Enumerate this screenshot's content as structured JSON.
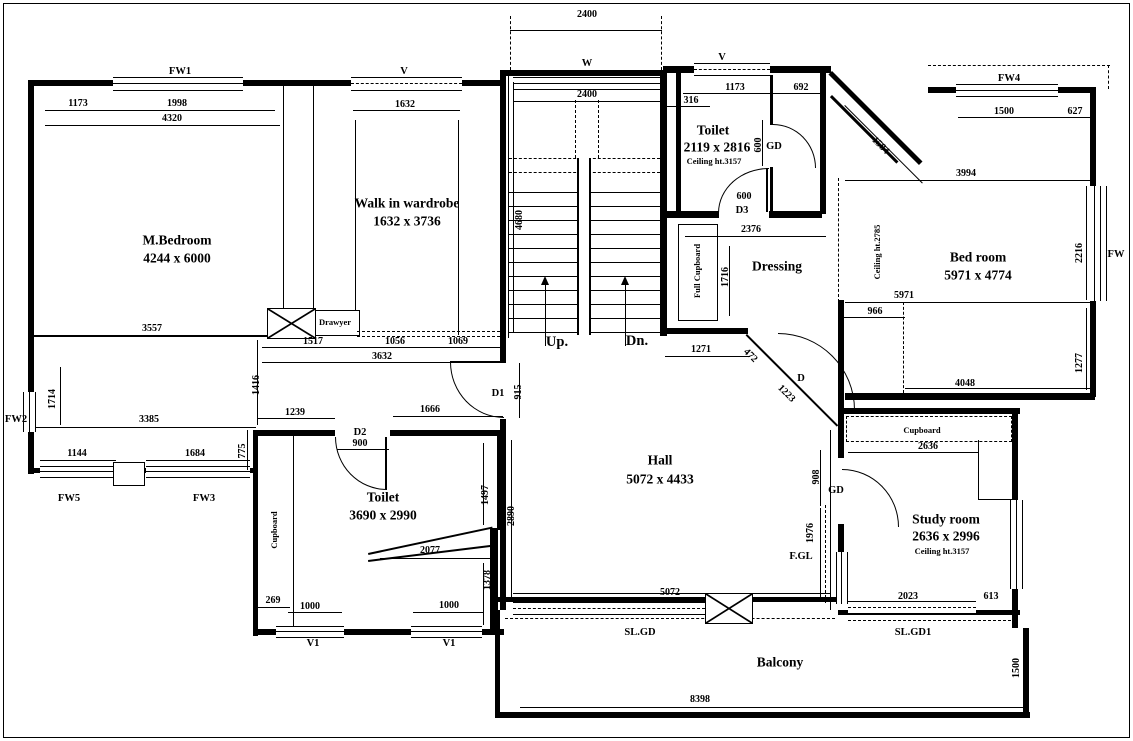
{
  "drawing_type": "residential floor plan",
  "labels": {
    "m_bedroom": [
      {
        "id": "fw1",
        "t": "FW1",
        "x": 180,
        "y": 72,
        "s": "tag"
      },
      {
        "id": "dim-1173",
        "t": "1173",
        "x": 78,
        "y": 104,
        "s": "dim"
      },
      {
        "id": "dim-1998",
        "t": "1998",
        "x": 177,
        "y": 104,
        "s": "dim"
      },
      {
        "id": "dim-4320",
        "t": "4320",
        "x": 172,
        "y": 119,
        "s": "dim"
      },
      {
        "id": "name",
        "t": "M.Bedroom",
        "x": 177,
        "y": 240,
        "s": "room"
      },
      {
        "id": "size",
        "t": "4244 x 6000",
        "x": 177,
        "y": 258,
        "s": "room"
      },
      {
        "id": "dim-3557",
        "t": "3557",
        "x": 152,
        "y": 329,
        "s": "dim"
      },
      {
        "id": "fw2",
        "t": "FW2",
        "x": 16,
        "y": 420,
        "s": "tag"
      },
      {
        "id": "dim-1714",
        "t": "1714",
        "x": 53,
        "y": 399,
        "s": "dim",
        "r": -90
      },
      {
        "id": "dim-3385",
        "t": "3385",
        "x": 149,
        "y": 420,
        "s": "dim"
      },
      {
        "id": "dim-1144",
        "t": "1144",
        "x": 77,
        "y": 454,
        "s": "dim"
      },
      {
        "id": "dim-1684",
        "t": "1684",
        "x": 195,
        "y": 454,
        "s": "dim"
      },
      {
        "id": "dim-775",
        "t": "775",
        "x": 243,
        "y": 451,
        "s": "dim",
        "r": -90
      },
      {
        "id": "fw5",
        "t": "FW5",
        "x": 69,
        "y": 499,
        "s": "tag"
      },
      {
        "id": "fw3",
        "t": "FW3",
        "x": 204,
        "y": 499,
        "s": "tag"
      },
      {
        "id": "dim-1416",
        "t": "1416",
        "x": 257,
        "y": 385,
        "s": "dim",
        "r": -90
      }
    ],
    "wardrobe": [
      {
        "id": "v",
        "t": "V",
        "x": 404,
        "y": 72,
        "s": "tag"
      },
      {
        "id": "dim-1632",
        "t": "1632",
        "x": 405,
        "y": 105,
        "s": "dim"
      },
      {
        "id": "name",
        "t": "Walk in wardrobe",
        "x": 407,
        "y": 203,
        "s": "room"
      },
      {
        "id": "size",
        "t": "1632 x 3736",
        "x": 407,
        "y": 221,
        "s": "room"
      },
      {
        "id": "drawyer",
        "t": "Drawyer",
        "x": 335,
        "y": 322,
        "s": "sm"
      },
      {
        "id": "dim-1517",
        "t": "1517",
        "x": 313,
        "y": 342,
        "s": "dim"
      },
      {
        "id": "dim-1056",
        "t": "1056",
        "x": 395,
        "y": 342,
        "s": "dim"
      },
      {
        "id": "dim-1069",
        "t": "1069",
        "x": 458,
        "y": 342,
        "s": "dim"
      },
      {
        "id": "dim-3632",
        "t": "3632",
        "x": 382,
        "y": 357,
        "s": "dim"
      }
    ],
    "stairs": [
      {
        "id": "dim-2400-outer",
        "t": "2400",
        "x": 587,
        "y": 15,
        "s": "dim"
      },
      {
        "id": "w",
        "t": "W",
        "x": 587,
        "y": 64,
        "s": "tag"
      },
      {
        "id": "dim-2400-inner",
        "t": "2400",
        "x": 587,
        "y": 95,
        "s": "dim"
      },
      {
        "id": "dim-4680",
        "t": "4680",
        "x": 520,
        "y": 220,
        "s": "dim",
        "r": -90
      },
      {
        "id": "up",
        "t": "Up.",
        "x": 557,
        "y": 342,
        "s": "updn"
      },
      {
        "id": "dn",
        "t": "Dn.",
        "x": 637,
        "y": 341,
        "s": "updn"
      }
    ],
    "toilet_top": [
      {
        "id": "v",
        "t": "V",
        "x": 722,
        "y": 58,
        "s": "tag"
      },
      {
        "id": "dim-1173",
        "t": "1173",
        "x": 735,
        "y": 88,
        "s": "dim"
      },
      {
        "id": "dim-692",
        "t": "692",
        "x": 801,
        "y": 88,
        "s": "dim"
      },
      {
        "id": "dim-316",
        "t": "316",
        "x": 691,
        "y": 101,
        "s": "dim"
      },
      {
        "id": "name",
        "t": "Toilet",
        "x": 713,
        "y": 130,
        "s": "room"
      },
      {
        "id": "size",
        "t": "2119 x 2816",
        "x": 717,
        "y": 147,
        "s": "room"
      },
      {
        "id": "ceiling",
        "t": "Ceiling ht.3157",
        "x": 714,
        "y": 161,
        "s": "sm"
      },
      {
        "id": "dim-600-v",
        "t": "600",
        "x": 759,
        "y": 145,
        "s": "dim",
        "r": -90
      },
      {
        "id": "gd",
        "t": "GD",
        "x": 774,
        "y": 147,
        "s": "tag"
      },
      {
        "id": "dim-600",
        "t": "600",
        "x": 744,
        "y": 197,
        "s": "dim"
      },
      {
        "id": "d3",
        "t": "D3",
        "x": 742,
        "y": 211,
        "s": "tag"
      }
    ],
    "dressing": [
      {
        "id": "dim-2376",
        "t": "2376",
        "x": 751,
        "y": 230,
        "s": "dim"
      },
      {
        "id": "name",
        "t": "Dressing",
        "x": 777,
        "y": 266,
        "s": "room"
      },
      {
        "id": "full-cupboard",
        "t": "Full Cupboard",
        "x": 697,
        "y": 271,
        "s": "sm",
        "r": -90
      },
      {
        "id": "dim-1716",
        "t": "1716",
        "x": 726,
        "y": 277,
        "s": "dim",
        "r": -90
      },
      {
        "id": "dim-1584",
        "t": "1584",
        "x": 880,
        "y": 146,
        "s": "dim",
        "r": 45
      }
    ],
    "bed_room": [
      {
        "id": "fw4",
        "t": "FW4",
        "x": 1009,
        "y": 79,
        "s": "tag"
      },
      {
        "id": "dim-1500",
        "t": "1500",
        "x": 1004,
        "y": 112,
        "s": "dim"
      },
      {
        "id": "dim-627",
        "t": "627",
        "x": 1075,
        "y": 112,
        "s": "dim"
      },
      {
        "id": "dim-3994",
        "t": "3994",
        "x": 966,
        "y": 174,
        "s": "dim"
      },
      {
        "id": "name",
        "t": "Bed room",
        "x": 978,
        "y": 257,
        "s": "room"
      },
      {
        "id": "size",
        "t": "5971 x 4774",
        "x": 978,
        "y": 275,
        "s": "room"
      },
      {
        "id": "dim-2216",
        "t": "2216",
        "x": 1080,
        "y": 253,
        "s": "dim",
        "r": -90
      },
      {
        "id": "fw",
        "t": "FW",
        "x": 1116,
        "y": 255,
        "s": "tag"
      },
      {
        "id": "ceiling",
        "t": "Ceiling ht.2785",
        "x": 877,
        "y": 252,
        "s": "sm",
        "r": -90
      },
      {
        "id": "dim-5971",
        "t": "5971",
        "x": 904,
        "y": 296,
        "s": "dim"
      },
      {
        "id": "dim-966",
        "t": "966",
        "x": 875,
        "y": 312,
        "s": "dim"
      },
      {
        "id": "dim-4048",
        "t": "4048",
        "x": 965,
        "y": 384,
        "s": "dim"
      },
      {
        "id": "dim-1277",
        "t": "1277",
        "x": 1080,
        "y": 363,
        "s": "dim",
        "r": -90
      }
    ],
    "hall": [
      {
        "id": "d1",
        "t": "D1",
        "x": 498,
        "y": 394,
        "s": "tag"
      },
      {
        "id": "dim-915",
        "t": "915",
        "x": 519,
        "y": 392,
        "s": "dim",
        "r": -90
      },
      {
        "id": "dim-2890",
        "t": "2890",
        "x": 512,
        "y": 516,
        "s": "dim",
        "r": -90
      },
      {
        "id": "name",
        "t": "Hall",
        "x": 660,
        "y": 460,
        "s": "room"
      },
      {
        "id": "size",
        "t": "5072 x 4433",
        "x": 660,
        "y": 479,
        "s": "room"
      },
      {
        "id": "dim-1271",
        "t": "1271",
        "x": 701,
        "y": 350,
        "s": "dim"
      },
      {
        "id": "dim-472",
        "t": "472",
        "x": 750,
        "y": 356,
        "s": "dim",
        "r": 45
      },
      {
        "id": "dim-1223",
        "t": "1223",
        "x": 786,
        "y": 394,
        "s": "dim",
        "r": 45
      },
      {
        "id": "d",
        "t": "D",
        "x": 801,
        "y": 379,
        "s": "tag"
      },
      {
        "id": "dim-5072",
        "t": "5072",
        "x": 670,
        "y": 593,
        "s": "dim"
      }
    ],
    "toilet_bottom": [
      {
        "id": "dim-1239",
        "t": "1239",
        "x": 295,
        "y": 413,
        "s": "dim"
      },
      {
        "id": "dim-1666",
        "t": "1666",
        "x": 430,
        "y": 410,
        "s": "dim"
      },
      {
        "id": "d2",
        "t": "D2",
        "x": 360,
        "y": 433,
        "s": "tag"
      },
      {
        "id": "dim-900",
        "t": "900",
        "x": 360,
        "y": 444,
        "s": "dim"
      },
      {
        "id": "name",
        "t": "Toilet",
        "x": 383,
        "y": 497,
        "s": "room"
      },
      {
        "id": "size",
        "t": "3690 x 2990",
        "x": 383,
        "y": 515,
        "s": "room"
      },
      {
        "id": "cupboard",
        "t": "Cupboard",
        "x": 274,
        "y": 530,
        "s": "sm",
        "r": -90
      },
      {
        "id": "dim-1497",
        "t": "1497",
        "x": 486,
        "y": 495,
        "s": "dim",
        "r": -90
      },
      {
        "id": "dim-2077",
        "t": "2077",
        "x": 430,
        "y": 551,
        "s": "dim"
      },
      {
        "id": "dim-1378",
        "t": "1378",
        "x": 488,
        "y": 580,
        "s": "dim",
        "r": -90
      },
      {
        "id": "dim-269",
        "t": "269",
        "x": 273,
        "y": 601,
        "s": "dim"
      },
      {
        "id": "dim-1000-a",
        "t": "1000",
        "x": 310,
        "y": 607,
        "s": "dim"
      },
      {
        "id": "dim-1000-b",
        "t": "1000",
        "x": 449,
        "y": 606,
        "s": "dim"
      },
      {
        "id": "v1a",
        "t": "V1",
        "x": 313,
        "y": 644,
        "s": "tag"
      },
      {
        "id": "v1b",
        "t": "V1",
        "x": 449,
        "y": 644,
        "s": "tag"
      }
    ],
    "study": [
      {
        "id": "cupboard",
        "t": "Cupboard",
        "x": 922,
        "y": 430,
        "s": "sm"
      },
      {
        "id": "dim-2636",
        "t": "2636",
        "x": 928,
        "y": 447,
        "s": "dim"
      },
      {
        "id": "gd",
        "t": "GD",
        "x": 836,
        "y": 491,
        "s": "tag"
      },
      {
        "id": "dim-908",
        "t": "908",
        "x": 817,
        "y": 477,
        "s": "dim",
        "r": -90
      },
      {
        "id": "name",
        "t": "Study room",
        "x": 946,
        "y": 519,
        "s": "room"
      },
      {
        "id": "size",
        "t": "2636 x 2996",
        "x": 946,
        "y": 536,
        "s": "room"
      },
      {
        "id": "ceiling",
        "t": "Ceiling ht.3157",
        "x": 942,
        "y": 551,
        "s": "sm"
      },
      {
        "id": "dim-1976",
        "t": "1976",
        "x": 811,
        "y": 533,
        "s": "dim",
        "r": -90
      },
      {
        "id": "fgl",
        "t": "F.GL",
        "x": 801,
        "y": 557,
        "s": "tag"
      },
      {
        "id": "dim-2023",
        "t": "2023",
        "x": 908,
        "y": 597,
        "s": "dim"
      },
      {
        "id": "dim-613",
        "t": "613",
        "x": 991,
        "y": 597,
        "s": "dim"
      },
      {
        "id": "slgd1",
        "t": "SL.GD1",
        "x": 913,
        "y": 633,
        "s": "tag"
      }
    ],
    "balcony": [
      {
        "id": "slgd",
        "t": "SL.GD",
        "x": 640,
        "y": 633,
        "s": "tag"
      },
      {
        "id": "name",
        "t": "Balcony",
        "x": 780,
        "y": 662,
        "s": "room"
      },
      {
        "id": "dim-8398",
        "t": "8398",
        "x": 700,
        "y": 700,
        "s": "dim"
      },
      {
        "id": "dim-1500",
        "t": "1500",
        "x": 1017,
        "y": 668,
        "s": "dim",
        "r": -90
      }
    ]
  }
}
